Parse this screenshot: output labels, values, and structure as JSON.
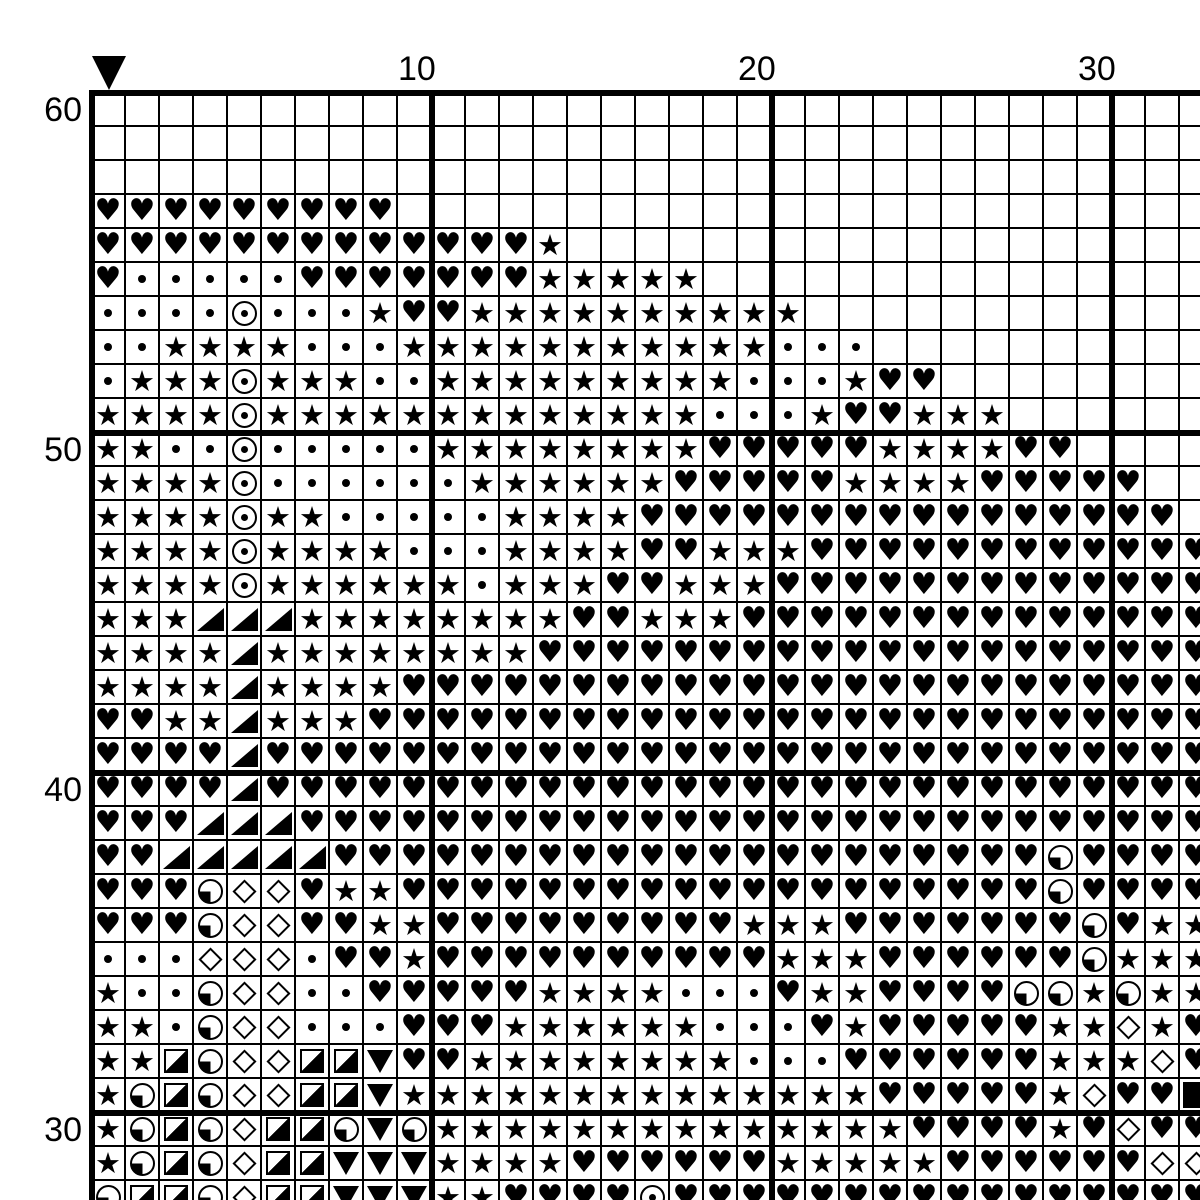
{
  "colors": {
    "ink": "#000000",
    "paper": "#ffffff"
  },
  "axis": {
    "col_labels": [
      {
        "text": "10",
        "col": 10
      },
      {
        "text": "20",
        "col": 20
      },
      {
        "text": "30",
        "col": 30
      }
    ],
    "row_labels": [
      {
        "text": "60",
        "row": 1
      },
      {
        "text": "50",
        "row": 11
      },
      {
        "text": "40",
        "row": 21
      },
      {
        "text": "30",
        "row": 31
      }
    ]
  },
  "marker": {
    "shape": "down-triangle",
    "col": 1
  },
  "legend": {
    ".": "empty",
    "H": "black-heart",
    "S": "black-star",
    "D": "small-dot",
    "O": "circled-dot",
    "T": "black-lower-right-triangle",
    "V": "black-down-triangle",
    "M": "diamond-outline",
    "Q": "circle-lower-left-quarter",
    "G": "square-lower-right-half",
    "F": "black-square"
  },
  "grid": {
    "columns": 33,
    "rows": 33,
    "rows_data": [
      ".................................",
      ".................................",
      ".................................",
      "HHHHHHHHH........................",
      "HHHHHHHHHHHHHS...................",
      "HDDDDDHHHHHHHSSSSS...............",
      "DDDDODDDSHHSSSSSSSSSS............",
      "DDSSSSDDDSSSSSSSSSSSDDD..........",
      "DSSSOSSSDDSSSSSSSSSDDDSHH........",
      "SSSSOSSSSSSSSSSSSSDDDSHHSSS......",
      "SSDDODDDDDSSSSSSSSHHHHHSSSSHH....",
      "SSSSODDDDDDSSSSSSHHHHHSSSSHHHHH..",
      "SSSSOSSDDDDDSSSSHHHHHHHHHHHHHHHH.",
      "SSSSOSSSSDDDSSSSHHSSSHHHHHHHHHHHH",
      "SSSSOSSSSSSDSSSHHSSSHHHHHHHHHHHHH",
      "SSSTTTSSSSSSSSHHSSSHHHHHHHHHHHHHH",
      "SSSSTSSSSSSSSHHHHHHHHHHHHHHHHHHHH",
      "SSSSTSSSSHHHHHHHHHHHHHHHHHHHHHHHH",
      "HHSSTSSSHHHHHHHHHHHHHHHHHHHHHHHHH",
      "HHHHTHHHHHHHHHHHHHHHHHHHHHHHHHHHH",
      "HHHHTHHHHHHHHHHHHHHHHHHHHHHHHHHHH",
      "HHHTTTHHHHHHHHHHHHHHHHHHHHHHHHHHH",
      "HHTTTTTHHHHHHHHHHHHHHHHHHHHHQHHHH",
      "HHHQMMHSSHHHHHHHHHHHHHHHHHHHQHHHH",
      "HHHQMMHHSSHHHHHHHHHSSSHHHHHHHQHSS",
      "DDDMMMDHHSHHHHHHHHHHSSSHHHHHHQSSS",
      "SDDQMMDDHHHHHSSSSDDDHSSHHHHQQSQSS",
      "SSDQMMDDDHHHSSSSSSDDDHSHHHHHSSMSH",
      "SSGQMMGGVHHSSSSSSSSDDDHHHHHHSSSMH",
      "SQGQMMGGVSSSSSSSSSSSSSSHHHHHSMHHF",
      "SQGQMGGQVQSSSSSSSSSSSSSSHHHHSHMHH",
      "SQGQMGGVVVSSSSHHHHHHSSSSSHHHHHHMM",
      "QGGQMGGVVVSSHHHHOHHHHHHHHHHHHHHHH"
    ]
  }
}
